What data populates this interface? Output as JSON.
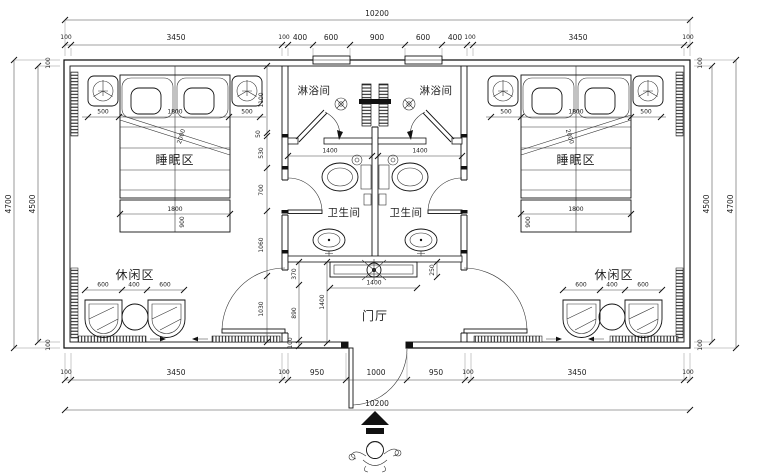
{
  "drawing": {
    "type_hint": "floor-plan",
    "labels": {
      "shower": "淋浴间",
      "wc": "卫生间",
      "sleep": "睡眠区",
      "leisure": "休闲区",
      "hall": "门厅"
    },
    "dims": {
      "total": "10200",
      "top": [
        "100",
        "3450",
        "100",
        "400",
        "600",
        "900",
        "600",
        "400",
        "100",
        "3450",
        "100"
      ],
      "bottom": [
        "100",
        "3450",
        "100",
        "950",
        "1000",
        "950",
        "100",
        "3450",
        "100"
      ],
      "left_outer": "4700",
      "left_inner": "4500",
      "right_inner": "4500",
      "right_outer": "4700",
      "wall": "100",
      "bed": [
        "500",
        "1800",
        "500"
      ],
      "bed_length": "2000",
      "bench_width": "1800",
      "bench_depth": "900",
      "leisure": [
        "600",
        "400",
        "600"
      ],
      "partition_chain": [
        "1100",
        "50",
        "530",
        "700",
        "1060",
        "1030"
      ],
      "bath_width": "1400",
      "hall_chain": [
        "370",
        "890",
        "100"
      ],
      "hall_depth": "1400",
      "counter_width": "1400",
      "counter_depth": "250"
    },
    "colors": {
      "line": "#111111",
      "background": "#ffffff"
    }
  }
}
